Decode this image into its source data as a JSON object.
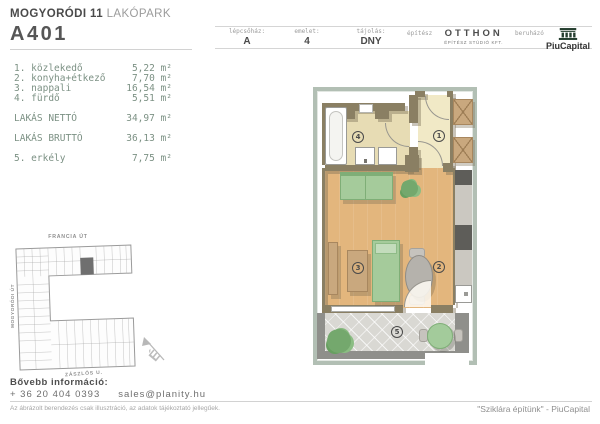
{
  "header": {
    "project_bold": "MOGYORÓDI 11",
    "project_light": "LAKÓPARK",
    "unit_id": "A401",
    "fields": [
      {
        "label": "lépcsőház:",
        "value": "A"
      },
      {
        "label": "emelet:",
        "value": "4"
      },
      {
        "label": "tájolás:",
        "value": "DNY"
      }
    ],
    "architect_label": "építész",
    "architect_name": "OTTHON",
    "architect_sub": "ÉPÍTÉSZ STÚDIÓ KFT.",
    "developer_label": "beruházó",
    "developer_name": "PiuCapital"
  },
  "rooms": [
    {
      "label": "1. közlekedő",
      "area": "5,22 m²"
    },
    {
      "label": "2. konyha+étkező",
      "area": "7,70 m²"
    },
    {
      "label": "3. nappali",
      "area": "16,54 m²"
    },
    {
      "label": "4. fürdő",
      "area": "5,51 m²"
    }
  ],
  "totals": [
    {
      "label": "LAKÁS NETTÓ",
      "area": "34,97 m²"
    },
    {
      "label": "LAKÁS BRUTTÓ",
      "area": "36,13 m²"
    }
  ],
  "extras": [
    {
      "label": "5. erkély",
      "area": "7,75 m²"
    }
  ],
  "site_plan": {
    "street_top": "FRANCIA ÚT",
    "street_left": "MOGYORÓDI ÚT",
    "street_bottom": "ZÁSZLÓS U.",
    "compass": "É"
  },
  "floor_plan": {
    "label_hall": "1",
    "label_kitchen": "2",
    "label_living": "3",
    "label_bath": "4",
    "label_balcony": "5"
  },
  "footer": {
    "info_label": "Bővebb információ:",
    "phone": "+ 36 20 404 0393",
    "email": "sales@planity.hu",
    "disclaimer": "Az ábrázolt berendezés csak illusztráció, az adatok tájékoztató jellegűek.",
    "slogan": "\"Sziklára építünk\" - PiuCapital"
  },
  "colors": {
    "frame": "#b2bfb4",
    "walls": "#8a7f63",
    "wood_floor": "#e3b67d",
    "bath_floor": "#e7dcb4",
    "hall_floor": "#f1e9c6",
    "furniture_green": "#a5cb9b",
    "list_text": "#7c9184",
    "developer_logo_green": "#243d2e",
    "highlight_unit_gray": "#6f6f6f"
  }
}
